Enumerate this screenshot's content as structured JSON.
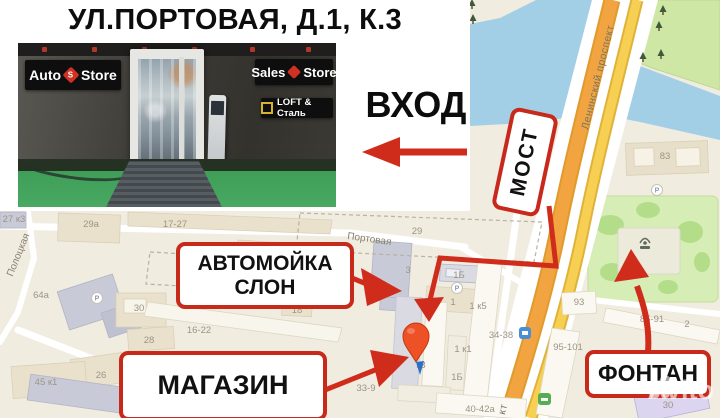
{
  "title": "УЛ.ПОРТОВАЯ, Д.1, К.3",
  "entrance_label": "ВХОД",
  "photo_signs": {
    "auto_1": "Auto",
    "auto_logo": "S",
    "auto_2": "Store",
    "sales_1": "Sales",
    "sales_2": "Store",
    "loft": "LOFT & Сталь"
  },
  "callouts": {
    "carwash_line1": "АВТОМОЙКА",
    "carwash_line2": "СЛОН",
    "shop": "МАГАЗИН",
    "fountain": "ФОНТАН",
    "bridge": "МОСТ"
  },
  "map": {
    "streets": {
      "leninsky": "Ленинский проспект",
      "leninsky_partial": "кт",
      "portovaya": "Портовая",
      "polotskaya": "Полоцкая"
    },
    "parking": "P",
    "labels": [
      {
        "t": "27 к3"
      },
      {
        "t": "29а"
      },
      {
        "t": "17-27"
      },
      {
        "t": "5-15"
      },
      {
        "t": "29"
      },
      {
        "t": "64а"
      },
      {
        "t": "30"
      },
      {
        "t": "28"
      },
      {
        "t": "16-22"
      },
      {
        "t": "18"
      },
      {
        "t": "26"
      },
      {
        "t": "45 к1"
      },
      {
        "t": "33-9"
      },
      {
        "t": "3"
      },
      {
        "t": "1Б"
      },
      {
        "t": "1"
      },
      {
        "t": "1 к5"
      },
      {
        "t": "34-38"
      },
      {
        "t": "1 к1"
      },
      {
        "t": "к3"
      },
      {
        "t": "1Б"
      },
      {
        "t": "40-42а"
      },
      {
        "t": "83"
      },
      {
        "t": "93"
      },
      {
        "t": "95-101"
      },
      {
        "t": "85-91"
      },
      {
        "t": "30"
      },
      {
        "t": "2"
      }
    ]
  },
  "watermark": "Avito",
  "colors": {
    "accent_red": "#cf2c1c",
    "water": "#a3cfe6",
    "road_orange": "#f1a43f",
    "road_yellow": "#f6cf53",
    "park_green": "#cfe7a5",
    "pin": "#ee5126"
  }
}
